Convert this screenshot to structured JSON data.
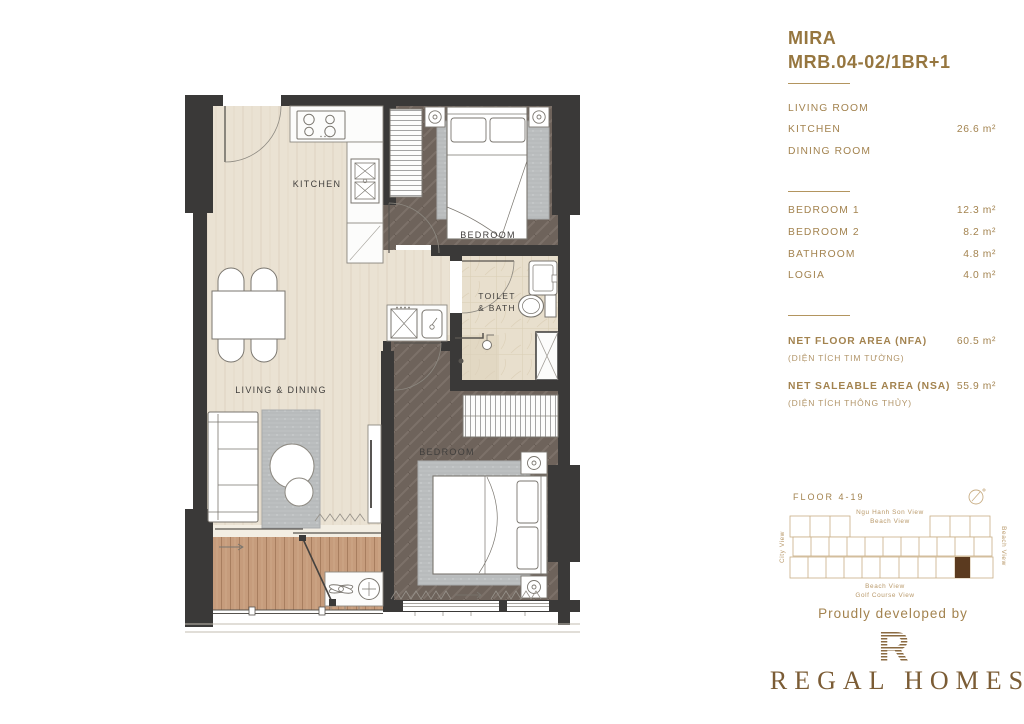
{
  "unit": {
    "name": "MIRA",
    "code": "MRB.04-02/1BR+1"
  },
  "room_groups": {
    "group1": [
      {
        "label": "LIVING ROOM",
        "value": ""
      },
      {
        "label": "KITCHEN",
        "value": "26.6 m²"
      },
      {
        "label": "DINING ROOM",
        "value": ""
      }
    ],
    "group2": [
      {
        "label": "BEDROOM 1",
        "value": "12.3 m²"
      },
      {
        "label": "BEDROOM 2",
        "value": "8.2 m²"
      },
      {
        "label": "BATHROOM",
        "value": "4.8 m²"
      },
      {
        "label": "LOGIA",
        "value": "4.0 m²"
      }
    ]
  },
  "areas": {
    "nfa": {
      "label": "NET FLOOR AREA (NFA)",
      "sub": "(DIỆN TÍCH TIM TƯỜNG)",
      "value": "60.5 m²"
    },
    "nsa": {
      "label": "NET SALEABLE AREA (NSA)",
      "sub": "(DIỆN TÍCH THÔNG THỦY)",
      "value": "55.9 m²"
    }
  },
  "keyplan": {
    "floor_label": "FLOOR 4-19",
    "top_label_1": "Ngu Hanh Son View",
    "top_label_2": "Beach View",
    "left_label": "City View",
    "right_label": "Beach View",
    "bottom_label_1": "Beach View",
    "bottom_label_2": "Golf Course View",
    "highlight_color": "#5b3a1f"
  },
  "footer": {
    "tagline": "Proudly developed by",
    "brand": "REGAL HOMES",
    "brand_initial": "R"
  },
  "plan_labels": {
    "kitchen": "KITCHEN",
    "bedroom_1": "BEDROOM",
    "toilet_line1": "TOILET",
    "toilet_line2": "& BATH",
    "living_dining": "LIVING & DINING",
    "bedroom_2": "BEDROOM"
  },
  "colors": {
    "accent_gold": "#a3834f",
    "title_brown": "#96763f",
    "brand_brown": "#7b5c35",
    "wall_dark": "#3a3938",
    "floor_light": "#eae2d3",
    "floor_bedroom": "#6e635b",
    "floor_bath": "#e8dfcd",
    "deck_wood": "#c69c7c",
    "keyplan_line": "#c9ae85"
  }
}
